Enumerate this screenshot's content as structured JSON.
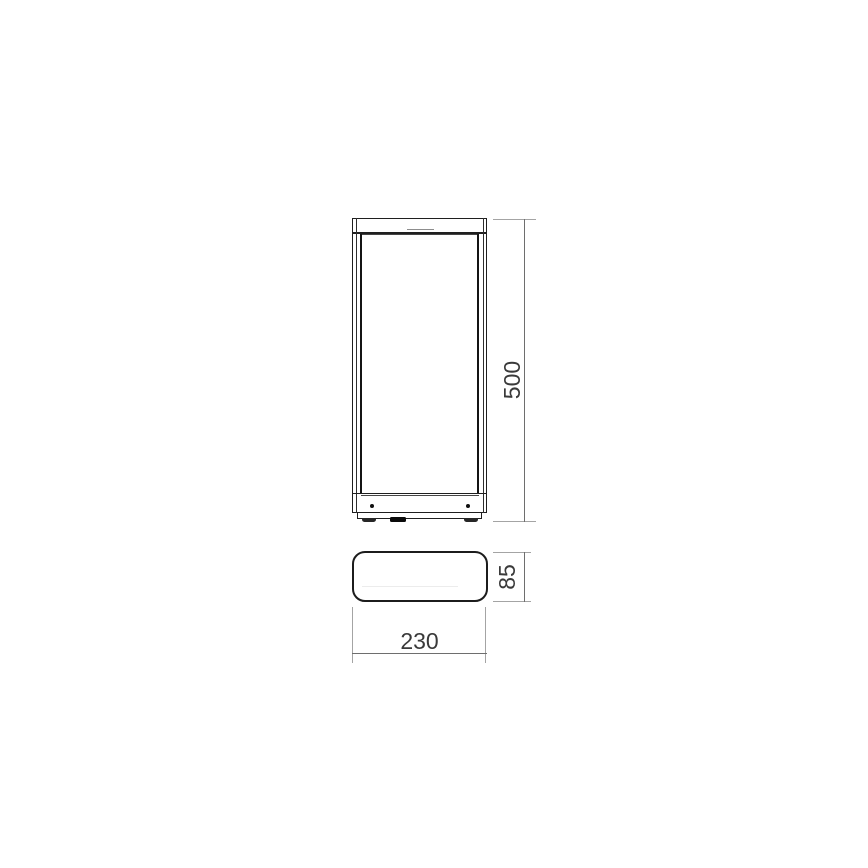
{
  "drawing": {
    "type": "technical-dimension-drawing",
    "subject": "rectangular-lantern-fixture",
    "colors": {
      "outline": "#1f1f1f",
      "dimension_line": "#6e6e6e",
      "extension_line": "#a4a4a4",
      "label_text": "#3a3a3a",
      "background": "#ffffff"
    },
    "views": {
      "front": {
        "name": "front-view"
      },
      "plan": {
        "name": "plan-view"
      }
    },
    "dimensions": {
      "height": {
        "label": "500"
      },
      "width": {
        "label": "230"
      },
      "depth": {
        "label": "85"
      }
    }
  }
}
